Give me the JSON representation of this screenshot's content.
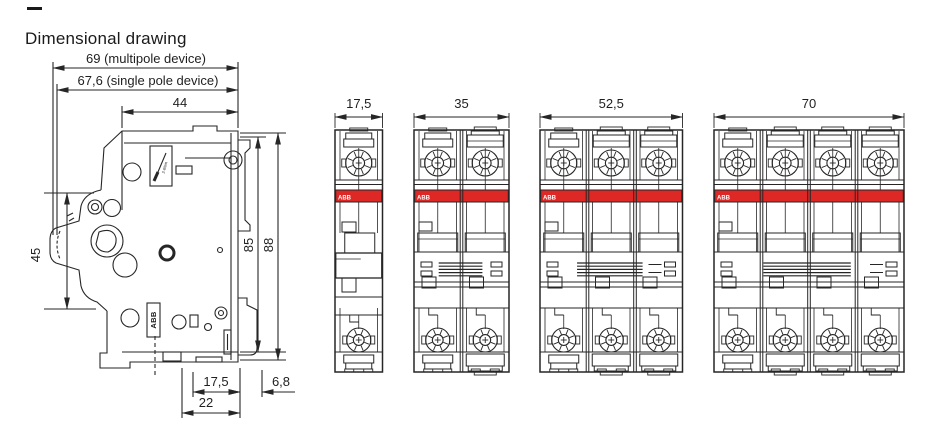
{
  "page": {
    "dash": "—",
    "title": "Dimensional drawing"
  },
  "colors": {
    "line": "#262626",
    "red": "#dd2826",
    "text": "#1f1f1f",
    "white": "#ffffff"
  },
  "side_view": {
    "dim_top": [
      "69 (multipole device)",
      "67,6 (single pole device)",
      "44"
    ],
    "dim_left": "45",
    "dim_right": [
      "85",
      "88"
    ],
    "dim_bottom": [
      "17,5",
      "6,8",
      "22"
    ],
    "abb_logo": "ABB",
    "torque_label": "2-6Nm"
  },
  "front_views": {
    "brand": "ABB",
    "items": [
      {
        "poles": 1,
        "width_label": "17,5"
      },
      {
        "poles": 2,
        "width_label": "35"
      },
      {
        "poles": 3,
        "width_label": "52,5"
      },
      {
        "poles": 4,
        "width_label": "70"
      }
    ]
  }
}
